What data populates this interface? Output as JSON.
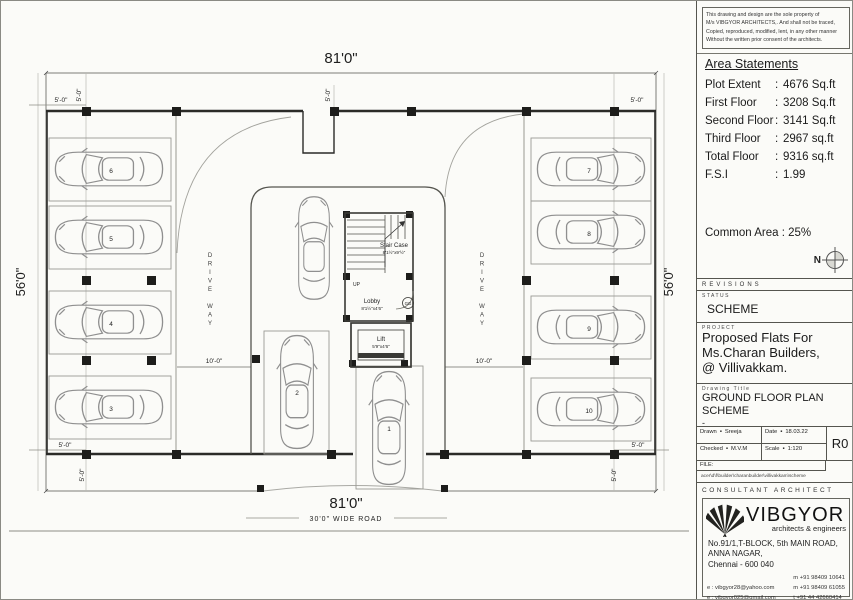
{
  "disclaimer": {
    "lines": [
      "This drawing and design are the sole property of",
      "M/s VIBGYOR ARCHITECTS,. And shall not be traced,",
      "Copied, reproduced, modified, lent, in any other manner",
      "Without the written prior consent of the architects."
    ]
  },
  "area_statements": {
    "title": "Area Statements",
    "rows": [
      {
        "label": "Plot Extent",
        "sep": ":",
        "value": "4676 Sq.ft"
      },
      {
        "label": "First Floor",
        "sep": ":",
        "value": "3208 Sq.ft"
      },
      {
        "label": "Second Floor",
        "sep": ":",
        "value": "3141 Sq.ft"
      },
      {
        "label": "Third Floor",
        "sep": ":",
        "value": "2967 sq.ft"
      },
      {
        "label": "Total Floor",
        "sep": ":",
        "value": "9316 sq.ft"
      },
      {
        "label": "F.S.I",
        "sep": ":",
        "value": "1.99"
      }
    ]
  },
  "common_area": "Common Area : 25%",
  "north_label": "N",
  "revisions_label": "REVISIONS",
  "status": {
    "label": "STATUS",
    "value": "SCHEME"
  },
  "project": {
    "label": "PROJECT",
    "lines": [
      "Proposed Flats For",
      "Ms.Charan Builders,",
      "@ Villivakkam."
    ]
  },
  "drawing_title": {
    "label": "Drawing Title",
    "lines": [
      "GROUND FLOOR PLAN",
      "SCHEME"
    ],
    "dash": "-"
  },
  "title_block": {
    "bullet": "▪",
    "drawn_label": "Drawn",
    "drawn_value": "Sreeja",
    "date_label": "Date",
    "date_value": "18.03.22",
    "checked_label": "Checked",
    "checked_value": "M.V.M",
    "scale_label": "Scale",
    "scale_value": "1:120",
    "revision": "R0",
    "file_label": "FILE:",
    "file_path": "acer\\d\\f\\builder\\charanbuilder\\villivakkam\\scheme"
  },
  "consultant": {
    "header": "CONSULTANT ARCHITECT",
    "name": "VIBGYOR",
    "tagline": "architects & engineers",
    "address": [
      "No.91/1,T-BLOCK, 5th MAIN ROAD,",
      "ANNA NAGAR,",
      "Chennai - 600 040"
    ],
    "emails": [
      "e : vibgyor28@yahoo.com",
      "e : vibgyor025@gmail.com"
    ],
    "phones": [
      "m   +91 98409 10641",
      "m   +91 98409 61055",
      "t   +91 44 42660414"
    ]
  },
  "plan": {
    "dim_top": "81'0\"",
    "dim_bottom": "81'0\"",
    "dim_left": "56'0\"",
    "dim_right": "56'0\"",
    "road_label": "30'0\" WIDE ROAD",
    "setback_dim": "5'-0\"",
    "aisle_dim": "10'-0\"",
    "driveway_label": "DRIVE WAY",
    "stair_name": "Stair Case",
    "stair_size": "8'1½\"x9'½\"",
    "lobby_name": "Lobby",
    "lobby_size": "8'1½\"x4'6\"",
    "lift_name": "Lift",
    "lift_size": "5'9\"x4'6\"",
    "up_label": "UP",
    "door_label": "GG",
    "stalls": [
      "1",
      "2",
      "3",
      "4",
      "5",
      "6",
      "7",
      "8",
      "9",
      "10"
    ]
  }
}
